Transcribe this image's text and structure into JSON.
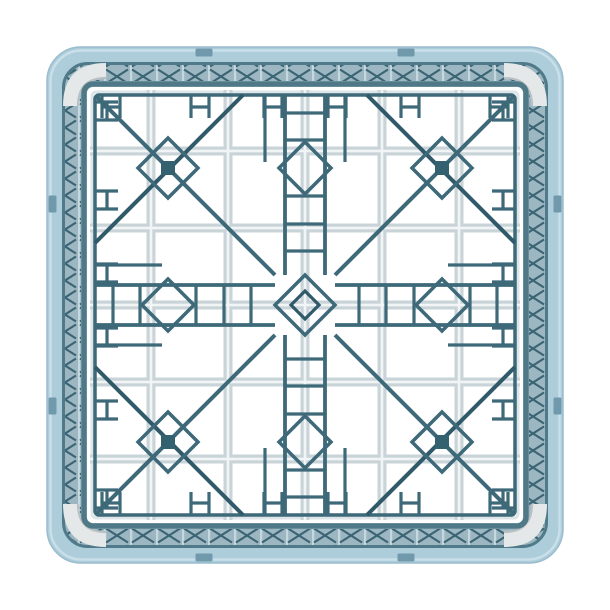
{
  "scene": {
    "type": "product-photo",
    "subject": "Light blue commercial dishwasher glass rack, top-down view on white background",
    "background": "#ffffff"
  },
  "palette": {
    "background": "#ffffff",
    "frame": "#aecdda",
    "frameHighlight": "#c9dfe9",
    "frameEdge": "#9abccd",
    "slot": "#7099ab",
    "rim": "#507a8a",
    "bandBg": "#9db7c2",
    "bandX": "#3b6474",
    "bandPost": "#c6d8df",
    "floorBar": "#507988",
    "cornerPost": "#e4e8e9",
    "cornerPostShadow": "#b9c1c4",
    "grayGrid": "#c9d4d9",
    "grayGridHi": "#f2f5f6",
    "innerEdge": "#dde5e8",
    "teal": "#3d6979",
    "tealDark": "#30596a",
    "solidSquare": "#34616f",
    "floor": "#ffffff"
  },
  "geometry": {
    "canvas": 610,
    "center": 305,
    "frame": {
      "x": 47,
      "size": 516,
      "rx": 34
    },
    "frameHighlight": {
      "x": 50.5,
      "size": 509,
      "rx": 31
    },
    "slotCenters": [
      204,
      406
    ],
    "slotLen": 17,
    "slotTh": 8,
    "band": {
      "x": 72.5,
      "size": 465,
      "rx": 17,
      "width": 17
    },
    "rim": {
      "x": 63.5,
      "size": 483,
      "rx": 24,
      "width": 3
    },
    "floorWhite": {
      "x": 87,
      "size": 436,
      "rx": 6
    },
    "floorBar": {
      "x": 84,
      "size": 442,
      "rx": 9,
      "width": 5.5
    },
    "innerEdge": {
      "x": 92,
      "size": 426,
      "rx": 4,
      "width": 3
    },
    "grayLines": [
      151,
      228,
      305,
      382,
      459
    ],
    "graySpan": [
      90,
      520
    ],
    "grayW": 9,
    "grayHiW": 2.6,
    "rail": {
      "x": 95,
      "size": 420,
      "rx": 4,
      "width": 3.5
    },
    "motifCenters": [
      [
        168,
        168
      ],
      [
        442,
        168
      ],
      [
        168,
        442
      ],
      [
        442,
        442
      ]
    ],
    "motifDiamondR": 30,
    "solidSquareSize": 14,
    "edgeDiamonds": [
      [
        305,
        168
      ],
      [
        168,
        305
      ],
      [
        442,
        305
      ],
      [
        305,
        442
      ]
    ],
    "edgeDiamondR": 26,
    "centerDiamondR1": 30,
    "centerDiamondR2": 14,
    "longDiagonals": [
      [
        97,
        97,
        275,
        275
      ],
      [
        513,
        97,
        335,
        275
      ],
      [
        97,
        513,
        275,
        335
      ],
      [
        513,
        513,
        335,
        335
      ]
    ],
    "antiDiagonals": [
      [
        243,
        95,
        95,
        243
      ],
      [
        367,
        95,
        515,
        243
      ],
      [
        95,
        367,
        243,
        515
      ],
      [
        515,
        367,
        367,
        515
      ]
    ],
    "railOffset": 20,
    "railOuterOffset": 40,
    "railSegments": [
      [
        96,
        275
      ],
      [
        335,
        514
      ]
    ],
    "railOuterSegments": [
      [
        96,
        162
      ],
      [
        448,
        514
      ]
    ],
    "rungs": [
      113,
      140,
      196,
      224,
      251,
      359,
      386,
      414,
      470,
      497
    ],
    "hCenters": [
      111,
      200,
      273,
      337,
      410,
      499
    ],
    "hHalf": 9,
    "hNear": 95,
    "hFar": 118,
    "hBarOff": 12,
    "bandTile": {
      "w": 26,
      "h": 17
    }
  }
}
